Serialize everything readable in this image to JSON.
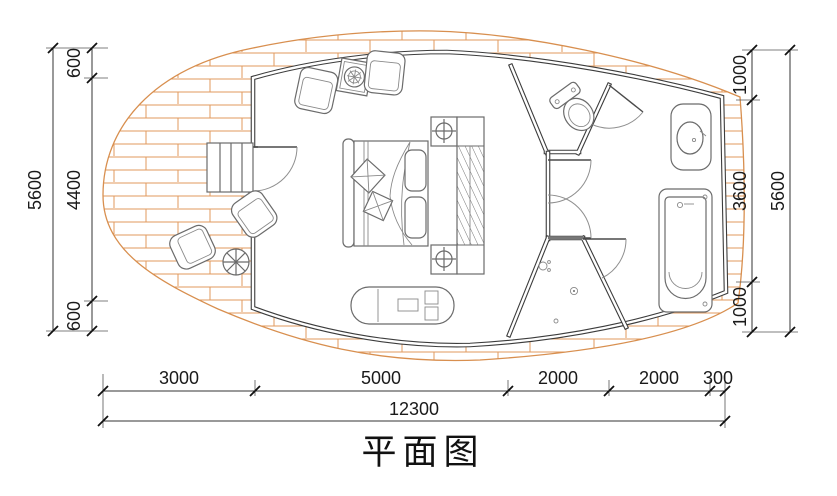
{
  "title": "平面图",
  "colors": {
    "brick_hatch": "#e09a5e",
    "envelope_outline": "#d88f4f",
    "wall_line": "#3c3c3c",
    "furniture_line": "#6b6b6b",
    "dimension_text": "#1a1a1a"
  },
  "dimensions": {
    "left": {
      "overall": "5600",
      "segments": [
        "600",
        "4400",
        "600"
      ]
    },
    "right": {
      "overall": "5600",
      "segments": [
        "1000",
        "3600",
        "1000"
      ]
    },
    "bottom": {
      "overall": "12300",
      "segments": [
        "3000",
        "5000",
        "2000",
        "2000",
        "300"
      ]
    }
  }
}
